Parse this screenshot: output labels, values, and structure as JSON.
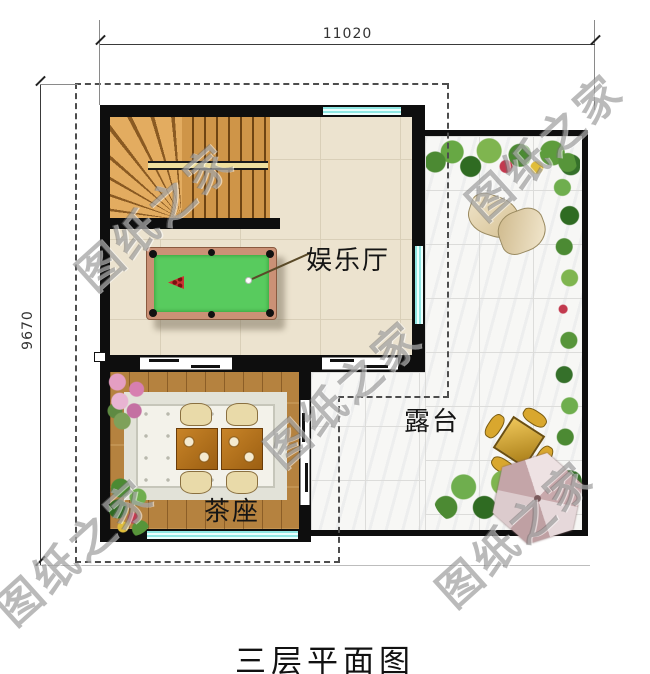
{
  "page_title": "三层平面图",
  "dimensions": {
    "top": "11020",
    "left": "9670"
  },
  "rooms": {
    "entertainment": {
      "label": "娱乐厅"
    },
    "tea": {
      "label": "茶座"
    },
    "terrace": {
      "label": "露台"
    }
  },
  "watermark": {
    "text": "图纸之家"
  },
  "colors": {
    "wall": "#0e0e0e",
    "window_glass": "#8fe7e3",
    "hall_tile": "#ece3cf",
    "wood_floor": "#b5823f",
    "terrace_tile": "#f7f7f5",
    "pool_felt": "#58cb5e",
    "pool_rail": "#cb9176",
    "plant_green": "#4c8a33",
    "umbrella": "#c9a9ac",
    "outdoor_set": "#d9a72e",
    "dashed_outline": "#4d4d4d"
  }
}
